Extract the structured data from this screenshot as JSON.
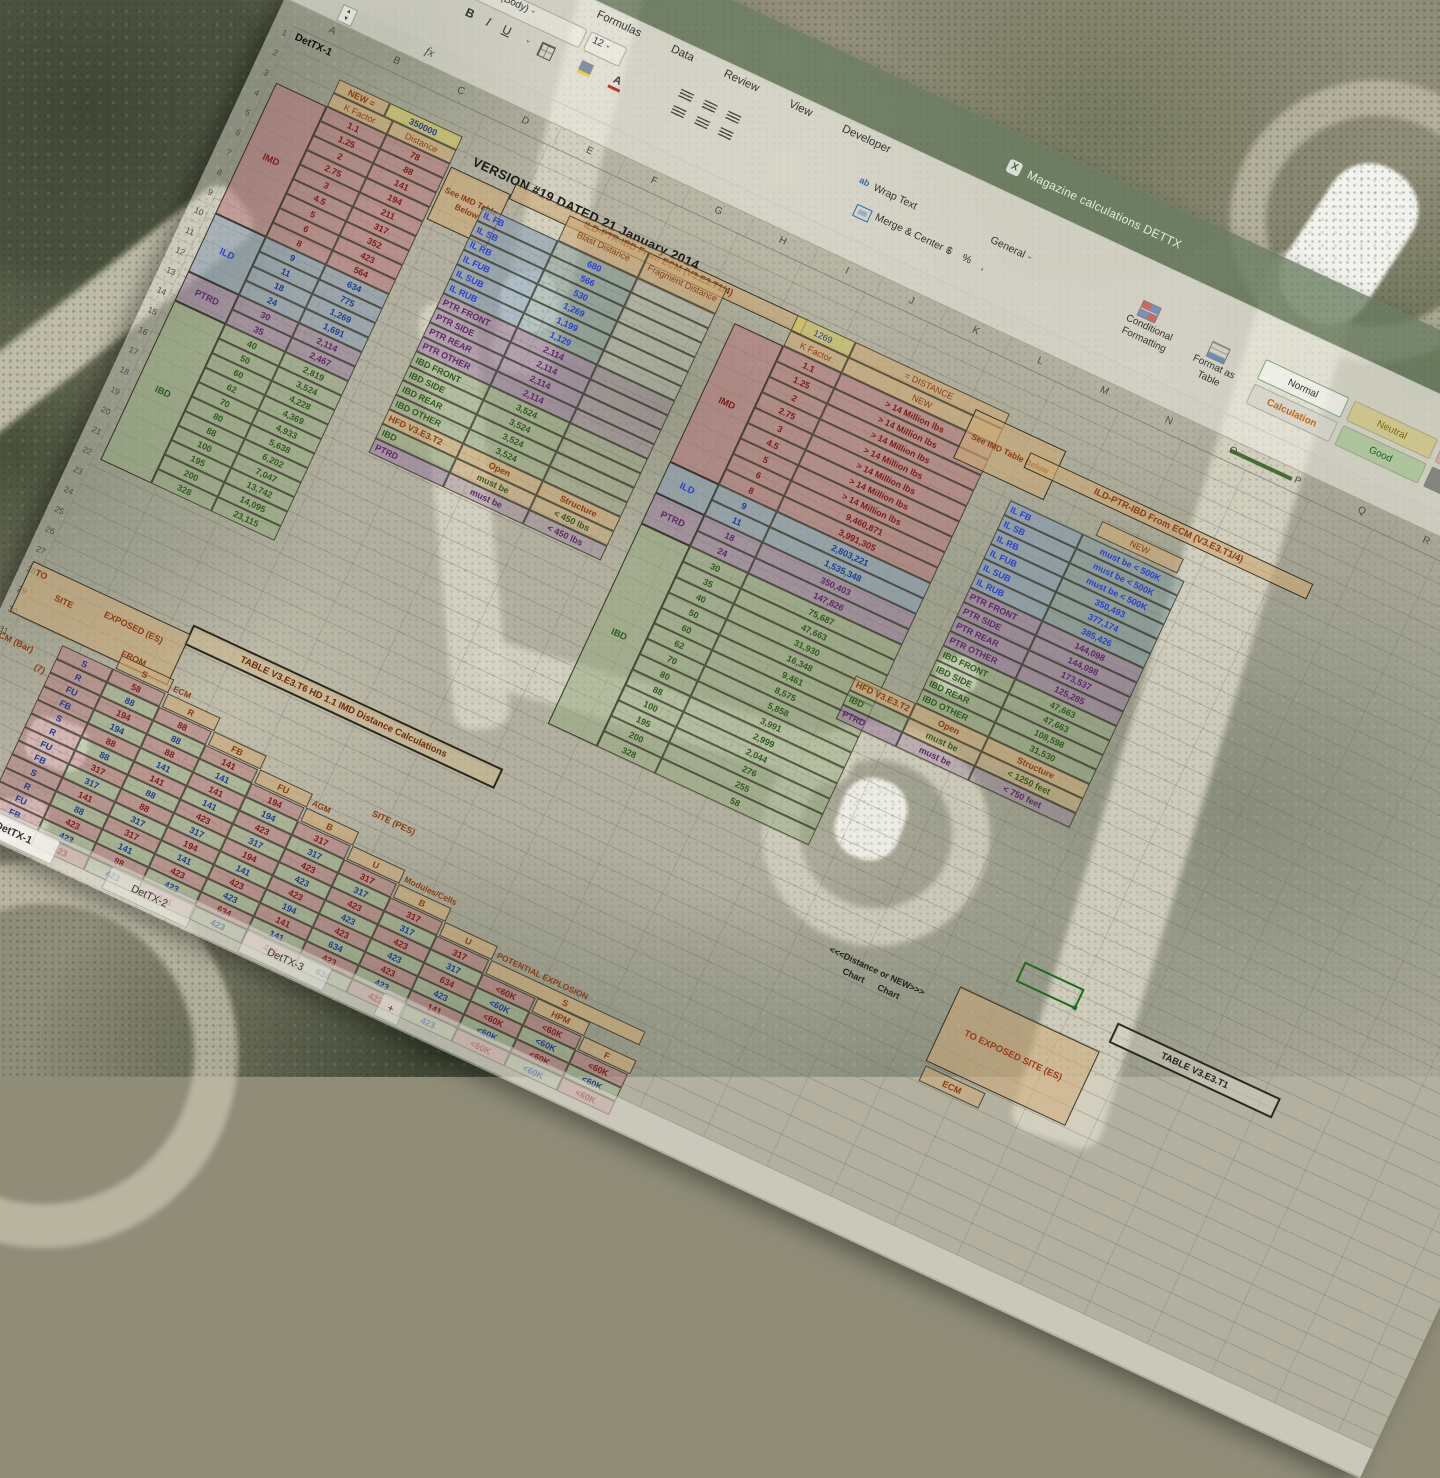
{
  "window": {
    "title": "Magazine calculations DETTX"
  },
  "ribbon": {
    "tabs": [
      "Formulas",
      "Data",
      "Review",
      "View",
      "Developer"
    ],
    "font_name": "Calibri (Body)",
    "font_size": "12",
    "bold": "B",
    "italic": "I",
    "underline": "U",
    "wrap_text": "Wrap Text",
    "merge_center": "Merge & Center",
    "number_format": "General",
    "currency": "$",
    "percent": "%",
    "comma": ",",
    "cond_fmt": "Conditional Formatting",
    "fmt_table": "Format as Table",
    "styles": [
      "Normal",
      "Neutral",
      "Bad",
      "Calculation",
      "Good",
      "Check Cell"
    ]
  },
  "sheet": {
    "cols": [
      "A",
      "B",
      "C",
      "D",
      "E",
      "F",
      "G",
      "H",
      "I",
      "J",
      "K",
      "L",
      "M",
      "N",
      "O",
      "P",
      "Q",
      "R"
    ],
    "rows": [
      "1",
      "2",
      "3",
      "4",
      "5",
      "6",
      "7",
      "8",
      "9",
      "10",
      "11",
      "12",
      "13",
      "14",
      "15",
      "16",
      "17",
      "18",
      "19",
      "20",
      "21",
      "22",
      "23",
      "24",
      "25",
      "26",
      "27",
      "28",
      "29",
      "30",
      "31",
      "32",
      "33",
      "34",
      "35",
      "36",
      "37",
      "38",
      "39"
    ],
    "tabs": [
      "DetTX-1",
      "DetTX-2",
      "DetTX-3",
      "+"
    ],
    "a1": "DetTX-1"
  },
  "notes": {
    "version": "VERSION #19   DATED 21 January 2014",
    "see_imd": "See IMD Table Below",
    "ecm_header": "ILD-PTR-IBD From ECM (V3.E3.T1/4)"
  },
  "t1": {
    "new_label": "NEW =",
    "new_value": "350000",
    "k_header": "K Factor",
    "d_header": "Distance",
    "sections": {
      "imd": "IMD",
      "ild": "ILD",
      "ptrd": "PTRD",
      "ibd": "IBD"
    },
    "rows": [
      {
        "k": "1.1",
        "d": "78",
        "sec": "imd"
      },
      {
        "k": "1.25",
        "d": "88",
        "sec": "imd"
      },
      {
        "k": "2",
        "d": "141",
        "sec": "imd"
      },
      {
        "k": "2.75",
        "d": "194",
        "sec": "imd"
      },
      {
        "k": "3",
        "d": "211",
        "sec": "imd"
      },
      {
        "k": "4.5",
        "d": "317",
        "sec": "imd"
      },
      {
        "k": "5",
        "d": "352",
        "sec": "imd"
      },
      {
        "k": "6",
        "d": "423",
        "sec": "imd"
      },
      {
        "k": "8",
        "d": "564",
        "sec": "imd"
      },
      {
        "k": "9",
        "d": "634",
        "sec": "ild"
      },
      {
        "k": "11",
        "d": "775",
        "sec": "ild"
      },
      {
        "k": "18",
        "d": "1,269",
        "sec": "ild"
      },
      {
        "k": "24",
        "d": "1,691",
        "sec": "ild"
      },
      {
        "k": "30",
        "d": "2,114",
        "sec": "ptrd"
      },
      {
        "k": "35",
        "d": "2,467",
        "sec": "ptrd"
      },
      {
        "k": "40",
        "d": "2,819",
        "sec": "ibd"
      },
      {
        "k": "50",
        "d": "3,524",
        "sec": "ibd"
      },
      {
        "k": "60",
        "d": "4,228",
        "sec": "ibd"
      },
      {
        "k": "62",
        "d": "4,369",
        "sec": "ibd"
      },
      {
        "k": "70",
        "d": "4,933",
        "sec": "ibd"
      },
      {
        "k": "80",
        "d": "5,638",
        "sec": "ibd"
      },
      {
        "k": "88",
        "d": "6,202",
        "sec": "ibd"
      },
      {
        "k": "100",
        "d": "7,047",
        "sec": "ibd"
      },
      {
        "k": "195",
        "d": "13,742",
        "sec": "ibd"
      },
      {
        "k": "200",
        "d": "14,095",
        "sec": "ibd"
      },
      {
        "k": "328",
        "d": "23,115",
        "sec": "ibd"
      }
    ]
  },
  "t2": {
    "blast_header": "Blast Distance",
    "frag_header": "Fragment Distance",
    "rows": [
      {
        "label": "IL FB",
        "blast": "680",
        "frag": "",
        "sec": "il"
      },
      {
        "label": "IL SB",
        "blast": "566",
        "frag": "",
        "sec": "il"
      },
      {
        "label": "IL RB",
        "blast": "530",
        "frag": "",
        "sec": "il"
      },
      {
        "label": "IL FUB",
        "blast": "1,269",
        "frag": "",
        "sec": "il"
      },
      {
        "label": "IL SUB",
        "blast": "1,199",
        "frag": "",
        "sec": "il"
      },
      {
        "label": "IL RUB",
        "blast": "1,129",
        "frag": "",
        "sec": "il"
      },
      {
        "label": "PTR FRONT",
        "blast": "2,114",
        "frag": "",
        "sec": "ptr"
      },
      {
        "label": "PTR SIDE",
        "blast": "2,114",
        "frag": "",
        "sec": "ptr"
      },
      {
        "label": "PTR REAR",
        "blast": "2,114",
        "frag": "",
        "sec": "ptr"
      },
      {
        "label": "PTR OTHER",
        "blast": "2,114",
        "frag": "",
        "sec": "ptr"
      },
      {
        "label": "IBD FRONT",
        "blast": "3,524",
        "frag": "",
        "sec": "ibd2"
      },
      {
        "label": "IBD SIDE",
        "blast": "3,524",
        "frag": "",
        "sec": "ibd2"
      },
      {
        "label": "IBD REAR",
        "blast": "3,524",
        "frag": "",
        "sec": "ibd2"
      },
      {
        "label": "IBD OTHER",
        "blast": "3,524",
        "frag": "",
        "sec": "ibd2"
      },
      {
        "label": "HFD V3.E3.T2",
        "blast": "Open",
        "frag": "Structure",
        "sec": "hfd"
      },
      {
        "label": "IBD",
        "blast": "must be",
        "frag": "< 450 lbs",
        "sec": "nibd"
      },
      {
        "label": "PTRD",
        "blast": "must be",
        "frag": "< 450 lbs",
        "sec": "nptrd"
      }
    ]
  },
  "t3": {
    "dist_value": "1269",
    "dist_label": "=  DISTANCE",
    "k_header": "K Factor",
    "new_header": "NEW",
    "sections": {
      "imd": "IMD",
      "ild": "ILD",
      "ptrd": "PTRD",
      "ibd": "IBD"
    },
    "rows": [
      {
        "k": "1.1",
        "v": "> 14 Million lbs",
        "sec": "imd"
      },
      {
        "k": "1.25",
        "v": "> 14 Million lbs",
        "sec": "imd"
      },
      {
        "k": "2",
        "v": "> 14 Million lbs",
        "sec": "imd"
      },
      {
        "k": "2.75",
        "v": "> 14 Million lbs",
        "sec": "imd"
      },
      {
        "k": "3",
        "v": "> 14 Million lbs",
        "sec": "imd"
      },
      {
        "k": "4.5",
        "v": "> 14 Million lbs",
        "sec": "imd"
      },
      {
        "k": "5",
        "v": "> 14 Million lbs",
        "sec": "imd"
      },
      {
        "k": "6",
        "v": "9,460,871",
        "sec": "imd"
      },
      {
        "k": "8",
        "v": "3,991,305",
        "sec": "imd"
      },
      {
        "k": "9",
        "v": "2,803,221",
        "sec": "ild"
      },
      {
        "k": "11",
        "v": "1,535,348",
        "sec": "ild"
      },
      {
        "k": "18",
        "v": "350,403",
        "sec": "ptrd"
      },
      {
        "k": "24",
        "v": "147,826",
        "sec": "ptrd"
      },
      {
        "k": "30",
        "v": "75,687",
        "sec": "ibd"
      },
      {
        "k": "35",
        "v": "47,663",
        "sec": "ibd"
      },
      {
        "k": "40",
        "v": "31,930",
        "sec": "ibd"
      },
      {
        "k": "50",
        "v": "16,348",
        "sec": "ibd"
      },
      {
        "k": "60",
        "v": "9,461",
        "sec": "ibd"
      },
      {
        "k": "62",
        "v": "8,575",
        "sec": "ibd"
      },
      {
        "k": "70",
        "v": "5,858",
        "sec": "ibd"
      },
      {
        "k": "80",
        "v": "3,991",
        "sec": "ibd"
      },
      {
        "k": "88",
        "v": "2,999",
        "sec": "ibd"
      },
      {
        "k": "100",
        "v": "2,044",
        "sec": "ibd"
      },
      {
        "k": "195",
        "v": "276",
        "sec": "ibd"
      },
      {
        "k": "200",
        "v": "255",
        "sec": "ibd"
      },
      {
        "k": "328",
        "v": "58",
        "sec": "ibd"
      }
    ]
  },
  "t4": {
    "new_header": "NEW",
    "rows": [
      {
        "label": "IL FB",
        "value": "must be < 500K",
        "sec": "il"
      },
      {
        "label": "IL SB",
        "value": "must be < 500K",
        "sec": "il"
      },
      {
        "label": "IL RB",
        "value": "must be < 500K",
        "sec": "il"
      },
      {
        "label": "IL FUB",
        "value": "350,493",
        "sec": "il"
      },
      {
        "label": "IL SUB",
        "value": "377,174",
        "sec": "il"
      },
      {
        "label": "IL RUB",
        "value": "385,426",
        "sec": "il"
      },
      {
        "label": "PTR FRONT",
        "value": "144,098",
        "sec": "ptr"
      },
      {
        "label": "PTR SIDE",
        "value": "144,098",
        "sec": "ptr"
      },
      {
        "label": "PTR REAR",
        "value": "173,537",
        "sec": "ptr"
      },
      {
        "label": "PTR OTHER",
        "value": "125,285",
        "sec": "ptr"
      },
      {
        "label": "IBD FRONT",
        "value": "47,663",
        "sec": "ibd2"
      },
      {
        "label": "IBD SIDE",
        "value": "47,663",
        "sec": "ibd2"
      },
      {
        "label": "IBD REAR",
        "value": "108,598",
        "sec": "ibd2"
      },
      {
        "label": "IBD OTHER",
        "value": "31,530",
        "sec": "ibd2"
      }
    ],
    "notes": [
      {
        "label": "HFD V3.E3.T2",
        "mid": "Open",
        "value": "Structure",
        "sec": "hfd"
      },
      {
        "label": "IBD",
        "mid": "must be",
        "value": "< 1250 feet",
        "sec": "nibd"
      },
      {
        "label": "PTRD",
        "mid": "must be",
        "value": "< 750 feet",
        "sec": "nptrd"
      }
    ]
  },
  "t5": {
    "title": "TABLE V3.E3.T6 HD 1.1 IMD Distance Calculations",
    "corner": {
      "to": "TO",
      "site": "SITE",
      "exposed": "EXPOSED (ES)",
      "from": "FROM"
    },
    "left_groups": [
      "ECM (Bar)",
      "(7)",
      "(3)"
    ],
    "supergroup": "SITE (PES)",
    "headers": [
      {
        "t": "S",
        "g": ""
      },
      {
        "t": "R",
        "g": "ECM"
      },
      {
        "t": "FB",
        "g": ""
      },
      {
        "t": "FU",
        "g": ""
      },
      {
        "t": "B",
        "g": "AGM"
      },
      {
        "t": "U",
        "g": ""
      },
      {
        "t": "B",
        "g": "Modules/Cells"
      },
      {
        "t": "U",
        "g": ""
      },
      {
        "t": "S",
        "g": "POTENTIAL EXPLOSION"
      },
      {
        "t": "HPM",
        "g": ""
      },
      {
        "t": "F",
        "g": ""
      }
    ],
    "rows": [
      {
        "l": "S",
        "cells": [
          "58"
        ]
      },
      {
        "l": "R",
        "cells": [
          "88",
          "88"
        ]
      },
      {
        "l": "FU",
        "cells": [
          "194",
          "88",
          "141"
        ]
      },
      {
        "l": "FB",
        "cells": [
          "194",
          "88",
          "141",
          "194"
        ]
      },
      {
        "l": "S",
        "cells": [
          "88",
          "141",
          "141",
          "194",
          "317"
        ]
      },
      {
        "l": "R",
        "cells": [
          "88",
          "141",
          "141",
          "423",
          "317",
          "317"
        ]
      },
      {
        "l": "FU",
        "cells": [
          "317",
          "88",
          "423",
          "317",
          "423",
          "317",
          "317"
        ]
      },
      {
        "l": "FB",
        "cells": [
          "317",
          "88",
          "317",
          "194",
          "423",
          "423",
          "317",
          "317"
        ]
      },
      {
        "l": "S",
        "cells": [
          "141",
          "317",
          "194",
          "141",
          "423",
          "423",
          "423",
          "317",
          "<60K"
        ]
      },
      {
        "l": "R",
        "cells": [
          "88",
          "317",
          "141",
          "423",
          "194",
          "423",
          "423",
          "634",
          "<60K",
          "<60K"
        ]
      },
      {
        "l": "FU",
        "cells": [
          "423",
          "141",
          "423",
          "423",
          "141",
          "634",
          "423",
          "423",
          "<60K",
          "<60K",
          "<60K"
        ]
      },
      {
        "l": "FB",
        "cells": [
          "423",
          "88",
          "423",
          "634",
          "141",
          "423",
          "423",
          "141",
          "<60K",
          "<60K",
          "<60K"
        ]
      },
      {
        "l": "S",
        "cells": [
          "423",
          "423",
          "141",
          "423",
          "423",
          "634",
          "423",
          "423",
          "<60K",
          "<60K",
          "<60K"
        ]
      }
    ]
  },
  "br": {
    "dist_new": "<<<Distance  or  NEW>>>",
    "chart1": "Chart",
    "chart2": "Chart",
    "to_es": "TO EXPOSED SITE (ES)",
    "table_ref": "TABLE V3.E3.T1",
    "ecm": "ECM"
  }
}
